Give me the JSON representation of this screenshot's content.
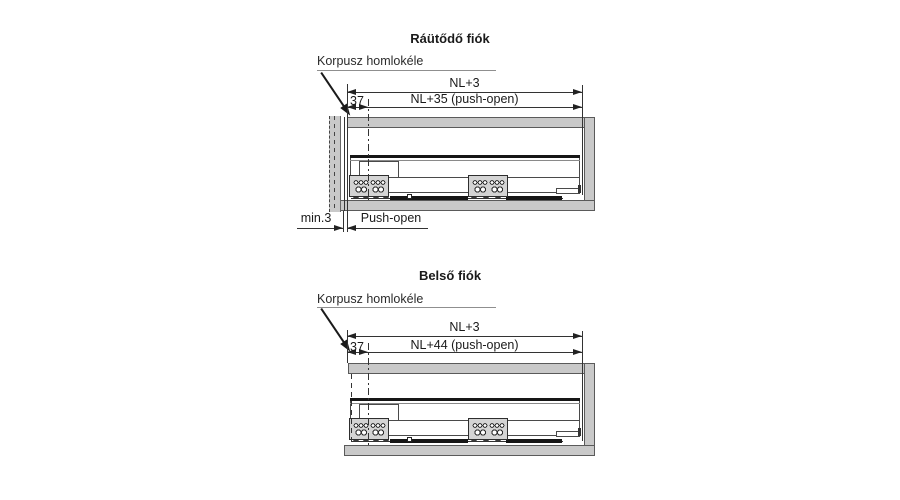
{
  "colors": {
    "background": "#ffffff",
    "panel_gray": "#c9c9c9",
    "line_dark": "#1a1a1a"
  },
  "diagram_top": {
    "title": "Ráütődő fiók",
    "carcass_edge_label": "Korpusz homlokéle",
    "dim_total": "NL+3",
    "dim_runner": "NL+35 (push-open)",
    "dim_front_offset": "37",
    "dim_min_gap": "min.3",
    "dim_gap_label": "Push-open"
  },
  "diagram_bottom": {
    "title": "Belső fiók",
    "carcass_edge_label": "Korpusz homlokéle",
    "dim_total": "NL+3",
    "dim_runner": "NL+44 (push-open)",
    "dim_front_offset": "37"
  }
}
